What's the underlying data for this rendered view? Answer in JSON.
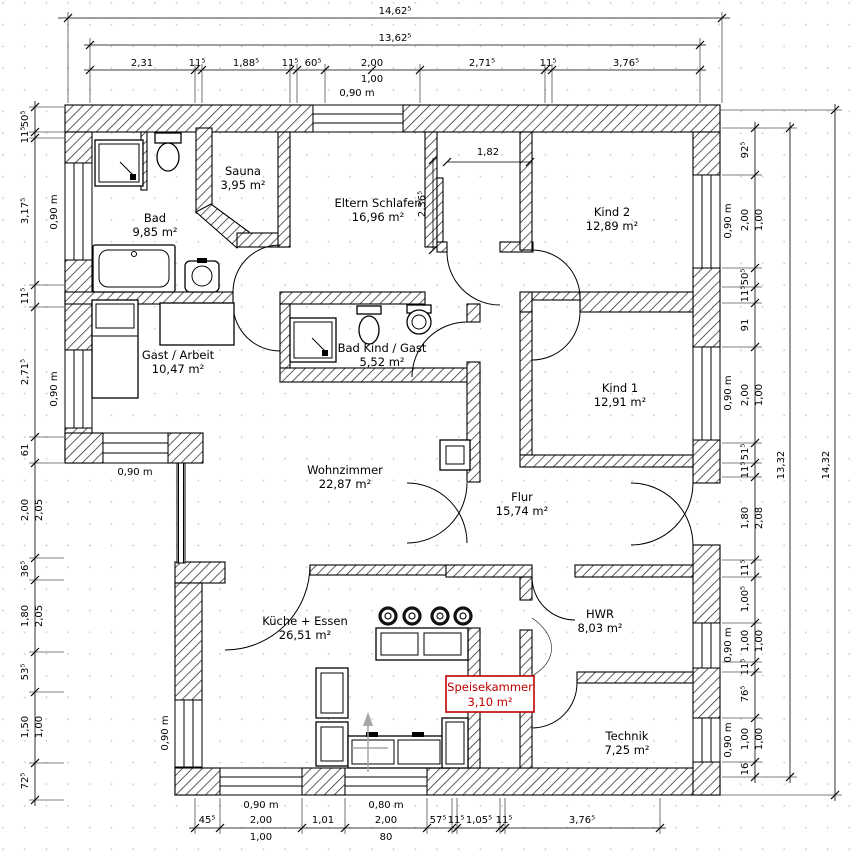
{
  "colors": {
    "annotation_red": "#c00000",
    "line_black": "#000000",
    "grid_dot": "#c8c8c8"
  },
  "rooms": {
    "bad": {
      "name": "Bad",
      "area": "9,85 m²"
    },
    "sauna": {
      "name": "Sauna",
      "area": "3,95 m²"
    },
    "eltern": {
      "name": "Eltern Schlafen",
      "area": "16,96 m²"
    },
    "kind2": {
      "name": "Kind 2",
      "area": "12,89 m²"
    },
    "gast": {
      "name": "Gast / Arbeit",
      "area": "10,47 m²"
    },
    "badkind": {
      "name": "Bad Kind / Gast",
      "area": "5,52 m²"
    },
    "kind1": {
      "name": "Kind 1",
      "area": "12,91 m²"
    },
    "wohnzimmer": {
      "name": "Wohnzimmer",
      "area": "22,87 m²"
    },
    "flur": {
      "name": "Flur",
      "area": "15,74 m²"
    },
    "kueche": {
      "name": "Küche + Essen",
      "area": "26,51 m²"
    },
    "hwr": {
      "name": "HWR",
      "area": "8,03 m²"
    },
    "speisekammer": {
      "name": "Speisekammer",
      "area": "3,10 m²"
    },
    "technik": {
      "name": "Technik",
      "area": "7,25 m²"
    }
  },
  "dims": {
    "top": {
      "total": "14,62⁵",
      "inner": "13,62⁵",
      "segs": [
        "2,31",
        "11⁵",
        "1,88⁵",
        "11⁵",
        "60⁵",
        "2,00",
        "2,71⁵",
        "11⁵",
        "3,76⁵"
      ],
      "sub": "1,00",
      "window": "0,90 m"
    },
    "bottom": {
      "segs": [
        "45⁵",
        "2,00",
        "1,01",
        "2,00",
        "57⁵",
        "11⁵",
        "1,05⁵",
        "11⁵",
        "3,76⁵"
      ],
      "sub1": "1,00",
      "sub2": "80",
      "window1": "0,90 m",
      "window2": "0,80 m"
    },
    "left": {
      "segs": [
        "50⁵",
        "11⁵",
        "3,17⁵",
        "11⁵",
        "2,71⁵",
        "61",
        "2,00",
        "36⁵",
        "1,80",
        "53⁵",
        "1,50",
        "72⁵"
      ],
      "col2": [
        "2,05",
        "2,05",
        "1,00"
      ]
    },
    "right": {
      "segs": [
        "92⁵",
        "2,00",
        "50⁵",
        "11⁵",
        "91",
        "2,00",
        "51⁵",
        "11⁵",
        "1,80",
        "11⁵",
        "1,00⁵",
        "1,00",
        "11⁵",
        "76⁵",
        "1,00",
        "16"
      ],
      "col2": [
        "1,00",
        "1,00",
        "2,08",
        "1,00",
        "1,00"
      ],
      "total_inner": "13,32",
      "total_outer": "14,32"
    },
    "interior": {
      "nook_width": "1,82",
      "nook_height": "2,36⁵"
    },
    "window_labels": {
      "w090": "0,90 m",
      "w080": "0,80 m"
    }
  }
}
